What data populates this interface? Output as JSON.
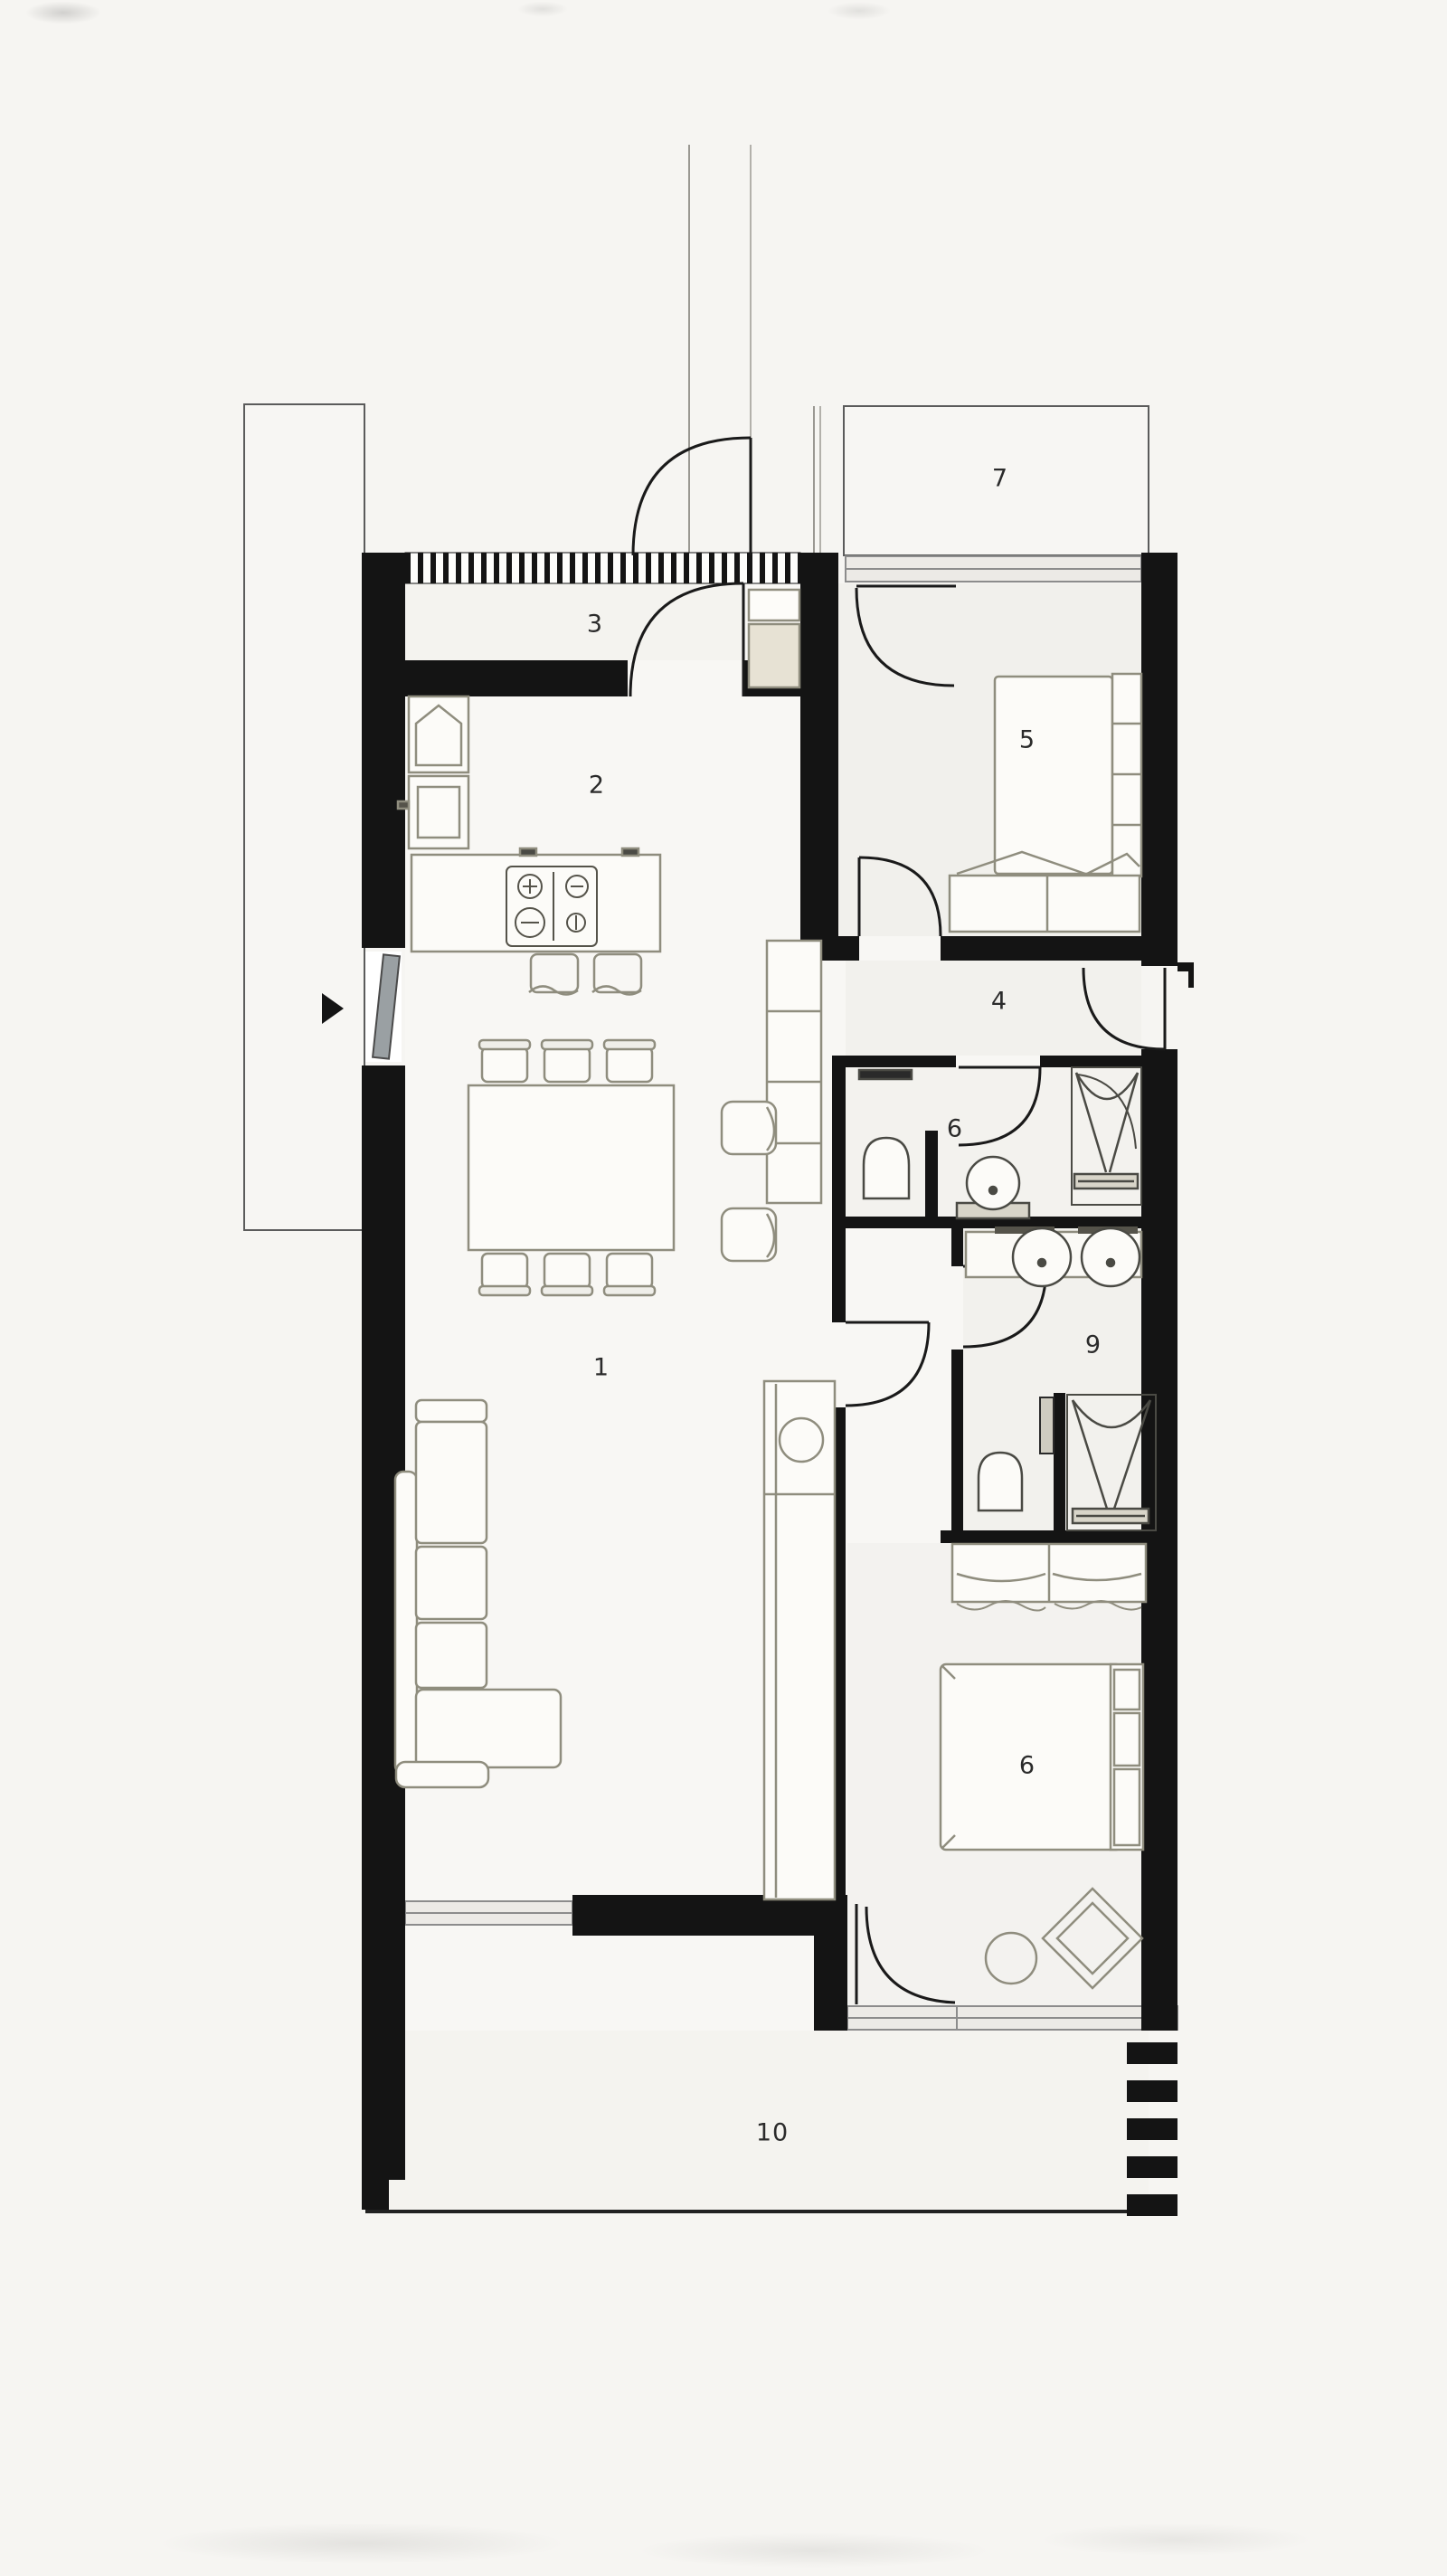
{
  "plan": {
    "room_labels": [
      {
        "text": "1"
      },
      {
        "text": "2"
      },
      {
        "text": "3"
      },
      {
        "text": "4"
      },
      {
        "text": "5"
      },
      {
        "text": "6"
      },
      {
        "text": "7"
      },
      {
        "text": "9"
      },
      {
        "text": "10"
      },
      {
        "text": "6"
      }
    ],
    "colors": {
      "wall": "#141414",
      "furniture_line": "#8f8d7e",
      "fixture_line": "#3a3a3a",
      "paper": "#f6f5f2",
      "glazing": "#d9d7d2",
      "accent_beige": "#e7e2d4"
    }
  }
}
